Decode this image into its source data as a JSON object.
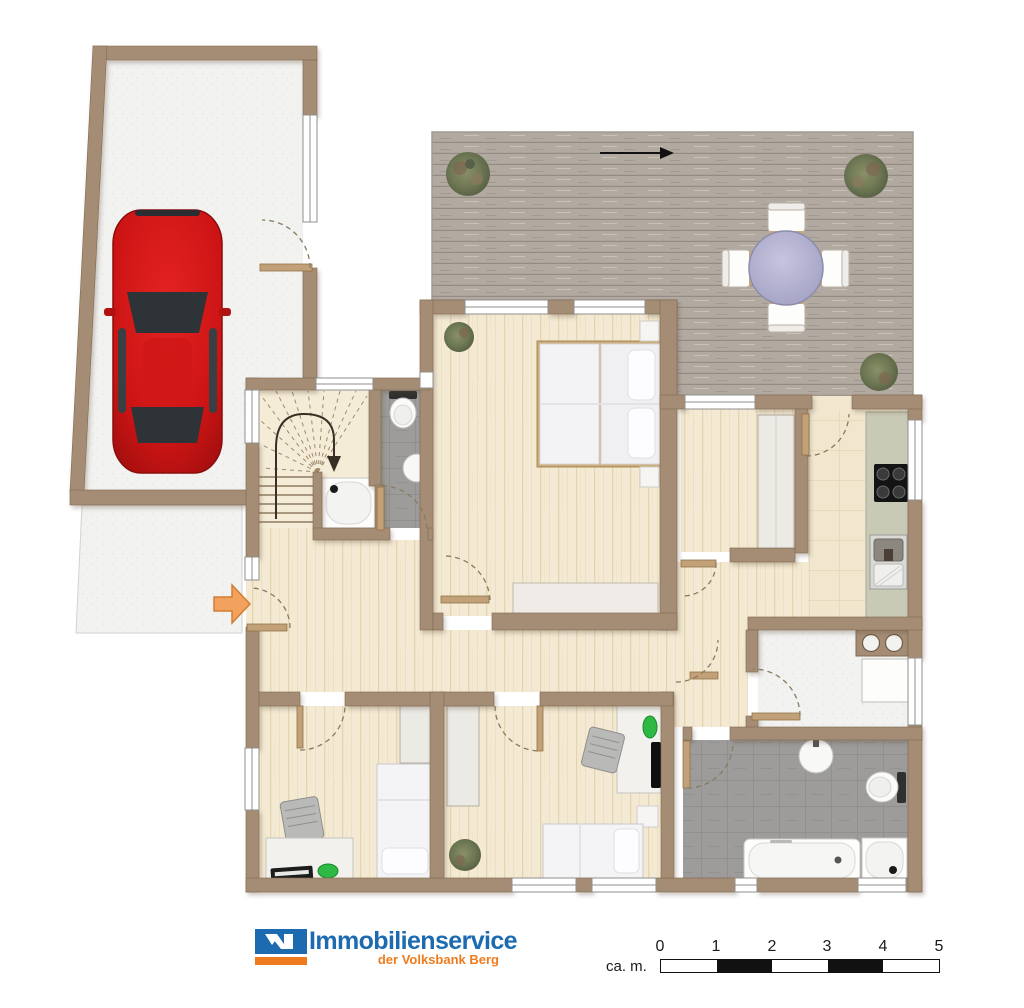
{
  "footer": {
    "brand": {
      "name": "Immobilienservice",
      "subtitle": "der Volksbank Berg",
      "brand_blue": "#1c6ab0",
      "brand_orange": "#ee7c1e"
    },
    "scale": {
      "label": "ca. m.",
      "ticks": [
        "0",
        "1",
        "2",
        "3",
        "4",
        "5"
      ]
    }
  },
  "colors": {
    "wall": "#a58d75",
    "wood_floor": "#f4ead3",
    "deck": "#b2aaa1",
    "tile_gray": "#9d9c9a",
    "tile_beige": "#f1e7cf",
    "concrete": "#f2f2f0",
    "car_red": "#d01717",
    "table_top": "#b5b3d2",
    "entrance_arrow": "#f2a25c",
    "door_leaf": "#c2a178"
  },
  "plan": {
    "type": "floor-plan",
    "rooms": [
      {
        "name": "garage",
        "furniture": [
          "car"
        ]
      },
      {
        "name": "driveway",
        "furniture": []
      },
      {
        "name": "terrace",
        "furniture": [
          "round-dining-table",
          "four-chairs",
          "plants",
          "direction-arrow"
        ]
      },
      {
        "name": "bedroom",
        "furniture": [
          "double-bed",
          "two-nightstands",
          "sideboard",
          "plant"
        ]
      },
      {
        "name": "dressing-room",
        "furniture": [
          "wardrobe"
        ]
      },
      {
        "name": "kitchen",
        "furniture": [
          "counter",
          "cooktop",
          "sink"
        ]
      },
      {
        "name": "utility-room",
        "furniture": [
          "twin-basins",
          "appliance"
        ]
      },
      {
        "name": "hallway",
        "furniture": [
          "entrance-arrow"
        ]
      },
      {
        "name": "staircase",
        "furniture": [
          "winder-stairs",
          "down-arrow"
        ]
      },
      {
        "name": "shower-wc",
        "furniture": [
          "toilet",
          "washbasin",
          "shower"
        ]
      },
      {
        "name": "bathroom",
        "furniture": [
          "bathtub",
          "shower",
          "toilet",
          "washbasin"
        ]
      },
      {
        "name": "kids-room-1",
        "furniture": [
          "single-bed",
          "desk",
          "chair",
          "keyboard",
          "mouse",
          "wardrobe"
        ]
      },
      {
        "name": "kids-room-2",
        "furniture": [
          "single-bed",
          "desk",
          "chair",
          "monitor",
          "wardrobe",
          "plant",
          "nightstand"
        ]
      }
    ]
  }
}
